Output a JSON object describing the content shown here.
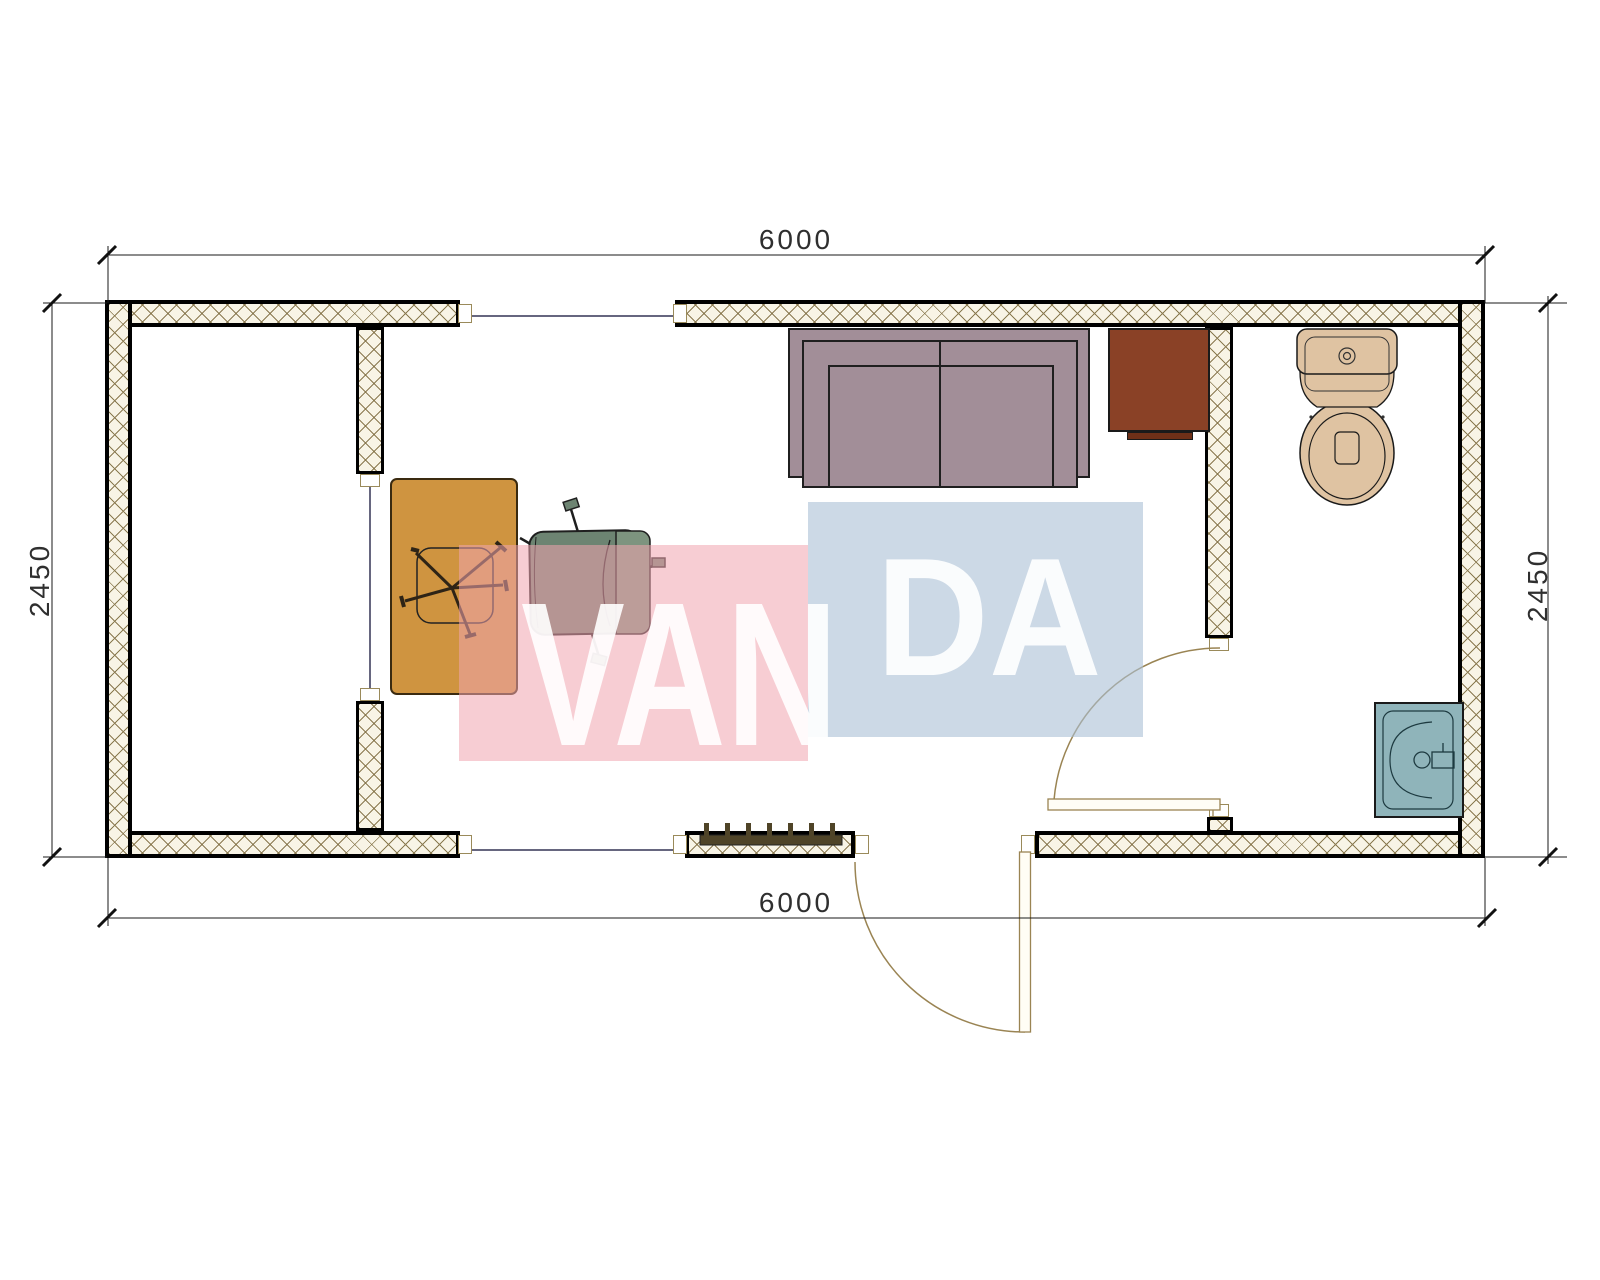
{
  "drawing": {
    "dimensions": {
      "top": "6000",
      "bottom": "6000",
      "left": "2450",
      "right": "2450"
    },
    "watermark": {
      "text_left": "VAN",
      "text_right": "DA"
    },
    "colors": {
      "wall_fill": "#f8f4e6",
      "hatch": "#8a7a50",
      "sofa": "#a28e98",
      "cabinet": "#8a4126",
      "cabinet_dark": "#6e3018",
      "desk": "#cf9440",
      "chair": "#6d8472",
      "chair_light": "#7d947f",
      "toilet": "#dfc3a2",
      "sink": "#8fb4ba",
      "radiator": "#4f4428",
      "door_line": "#9a8453",
      "window_line": "#333355",
      "dim_line": "#1a1a1a",
      "wm_pink": "#f0a4af",
      "wm_blue": "#aabfd5"
    }
  }
}
